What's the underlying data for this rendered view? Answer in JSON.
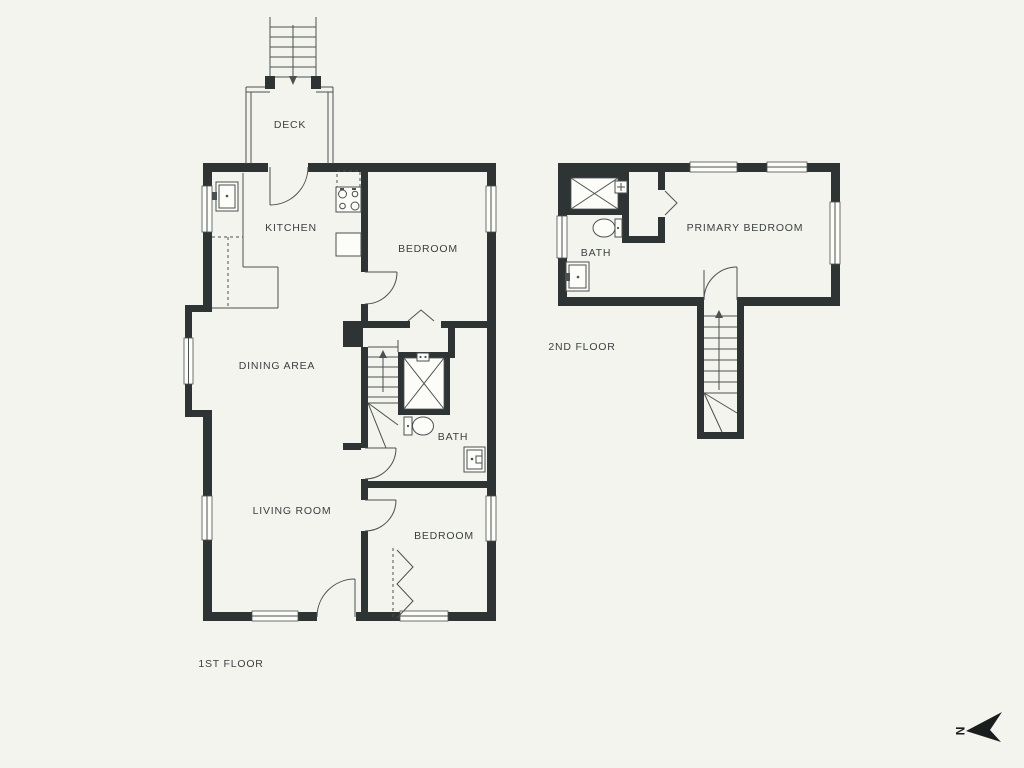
{
  "colors": {
    "background": "#f4f4ee",
    "wall": "#2e3334",
    "line": "#4b5051",
    "window_fill": "#fcfcf8",
    "text": "#3b4141",
    "compass": "#1a1d1d"
  },
  "first_floor": {
    "label": "1ST FLOOR",
    "rooms": {
      "deck": "DECK",
      "kitchen": "KITCHEN",
      "bedroom_top": "BEDROOM",
      "dining_area": "DINING AREA",
      "bath": "BATH",
      "living_room": "LIVING ROOM",
      "bedroom_bottom": "BEDROOM"
    }
  },
  "second_floor": {
    "label": "2ND FLOOR",
    "rooms": {
      "bath": "BATH",
      "primary_bedroom": "PRIMARY BEDROOM"
    }
  },
  "compass": {
    "letter": "N"
  }
}
